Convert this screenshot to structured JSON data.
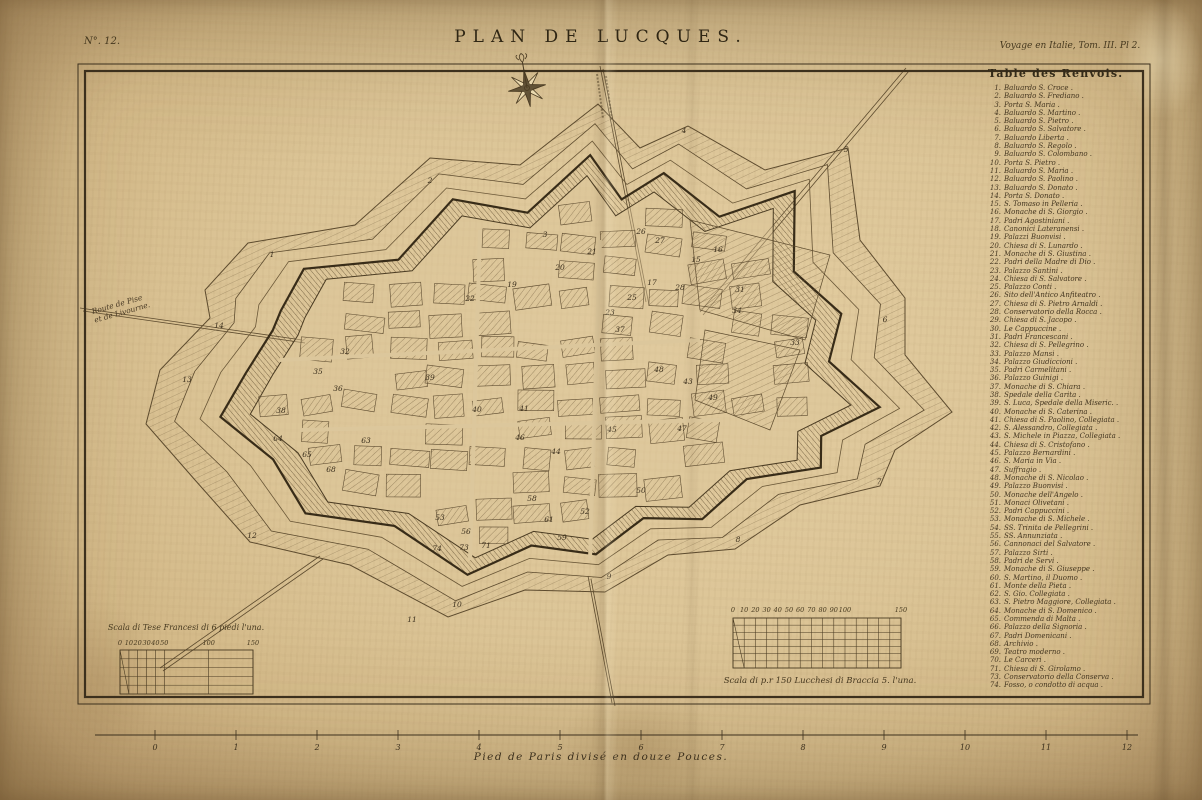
{
  "plate": {
    "number": "N°. 12.",
    "title": "PLAN DE LUCQUES.",
    "edition": "Voyage en Italie, Tom. III. Pl 2.",
    "bottom_caption": "Pied de Paris divisé en douze Pouces."
  },
  "legend": {
    "title": "Table des Renvois.",
    "items": [
      {
        "n": "1",
        "label": "Baluardo S. Croce"
      },
      {
        "n": "2",
        "label": "Baluardo S. Frediano"
      },
      {
        "n": "3",
        "label": "Porta S. Maria"
      },
      {
        "n": "4",
        "label": "Baluardo S. Martino"
      },
      {
        "n": "5",
        "label": "Baluardo S. Pietro"
      },
      {
        "n": "6",
        "label": "Baluardo S. Salvatore"
      },
      {
        "n": "7",
        "label": "Baluardo Liberta"
      },
      {
        "n": "8",
        "label": "Baluardo S. Regolo"
      },
      {
        "n": "9",
        "label": "Baluardo S. Colombano"
      },
      {
        "n": "10",
        "label": "Porta S. Pietro"
      },
      {
        "n": "11",
        "label": "Baluardo S. Maria"
      },
      {
        "n": "12",
        "label": "Baluardo S. Paolino"
      },
      {
        "n": "13",
        "label": "Baluardo S. Donato"
      },
      {
        "n": "14",
        "label": "Porta S. Donato"
      },
      {
        "n": "15",
        "label": "S. Tomaso in Pelleria"
      },
      {
        "n": "16",
        "label": "Monache di S. Giorgio"
      },
      {
        "n": "17",
        "label": "Padri Agostiniani"
      },
      {
        "n": "18",
        "label": "Canonici Lateranensi"
      },
      {
        "n": "19",
        "label": "Palazzi Buonvisi"
      },
      {
        "n": "20",
        "label": "Chiesa di S. Lunardo"
      },
      {
        "n": "21",
        "label": "Monache di S. Giustina"
      },
      {
        "n": "22",
        "label": "Padri della Madre di Dio"
      },
      {
        "n": "23",
        "label": "Palazzo Santini"
      },
      {
        "n": "24",
        "label": "Chiesa di S. Salvatore"
      },
      {
        "n": "25",
        "label": "Palazzo Conti"
      },
      {
        "n": "26",
        "label": "Sito dell'Antico Anfiteatro"
      },
      {
        "n": "27",
        "label": "Chiesa di S. Pietro Arnaldi"
      },
      {
        "n": "28",
        "label": "Conservatorio della Rocca"
      },
      {
        "n": "29",
        "label": "Chiesa di S. Jacopo"
      },
      {
        "n": "30",
        "label": "Le Cappuccine"
      },
      {
        "n": "31",
        "label": "Padri Francescani"
      },
      {
        "n": "32",
        "label": "Chiesa di S. Pellegrino"
      },
      {
        "n": "33",
        "label": "Palazzo Mansi"
      },
      {
        "n": "34",
        "label": "Palazzo Giudiccioni"
      },
      {
        "n": "35",
        "label": "Padri Carmelitani"
      },
      {
        "n": "36",
        "label": "Palazzo Guinigi"
      },
      {
        "n": "37",
        "label": "Monache di S. Chiara"
      },
      {
        "n": "38",
        "label": "Spedale della Carita"
      },
      {
        "n": "39",
        "label": "S. Luca, Spedale della Miseric."
      },
      {
        "n": "40",
        "label": "Monache di S. Caterina"
      },
      {
        "n": "41",
        "label": "Chiesa di S. Paolino, Collegiata"
      },
      {
        "n": "42",
        "label": "S. Alessandro, Collegiata"
      },
      {
        "n": "43",
        "label": "S. Michele in Piazza, Collegiata"
      },
      {
        "n": "44",
        "label": "Chiesa di S. Cristofano"
      },
      {
        "n": "45",
        "label": "Palazzo Bernardini"
      },
      {
        "n": "46",
        "label": "S. Maria in Via"
      },
      {
        "n": "47",
        "label": "Suffragio"
      },
      {
        "n": "48",
        "label": "Monache di S. Nicolao"
      },
      {
        "n": "49",
        "label": "Palazzo Buonvisi"
      },
      {
        "n": "50",
        "label": "Monache dell'Angelo"
      },
      {
        "n": "51",
        "label": "Monaci Olivetani"
      },
      {
        "n": "52",
        "label": "Padri Cappuccini"
      },
      {
        "n": "53",
        "label": "Monache di S. Michele"
      },
      {
        "n": "54",
        "label": "SS. Trinita de Pellegrini"
      },
      {
        "n": "55",
        "label": "SS. Annunziata"
      },
      {
        "n": "56",
        "label": "Cannonaci del Salvatore"
      },
      {
        "n": "57",
        "label": "Palazzo Sirti"
      },
      {
        "n": "58",
        "label": "Padri de Servi"
      },
      {
        "n": "59",
        "label": "Monache di S. Giuseppe"
      },
      {
        "n": "60",
        "label": "S. Martino, il Duomo"
      },
      {
        "n": "61",
        "label": "Monte della Pieta"
      },
      {
        "n": "62",
        "label": "S. Gio. Collegiata"
      },
      {
        "n": "63",
        "label": "S. Pietro Maggiore, Collegiata"
      },
      {
        "n": "64",
        "label": "Monache di S. Domenico"
      },
      {
        "n": "65",
        "label": "Commenda di Malta"
      },
      {
        "n": "66",
        "label": "Palazzo della Signoria"
      },
      {
        "n": "67",
        "label": "Padri Domenicani"
      },
      {
        "n": "68",
        "label": "Archivio"
      },
      {
        "n": "69",
        "label": "Teatro moderno"
      },
      {
        "n": "70",
        "label": "Le Carceri"
      },
      {
        "n": "71",
        "label": "Chiesa di S. Girolamo"
      },
      {
        "n": "73",
        "label": "Conservatorio della Conserva"
      },
      {
        "n": "74",
        "label": "Fosso, o condotto di acqua"
      }
    ]
  },
  "road_label": {
    "line1": "Route de Pise",
    "line2": "et de Livourne."
  },
  "scales": {
    "french": {
      "caption": "Scala di Tese Francesi di 6 piedi l'una.",
      "ticks": [
        "0",
        "10",
        "20",
        "30",
        "40",
        "50",
        "100",
        "150"
      ]
    },
    "lucchese": {
      "caption": "Scala di p.r 150 Lucchesi di Braccia 5. l'una.",
      "ticks": [
        "0",
        "10",
        "20",
        "30",
        "40",
        "50",
        "60",
        "70",
        "80",
        "90",
        "100",
        "150"
      ]
    }
  },
  "ruler": {
    "ticks": [
      "0",
      "1",
      "2",
      "3",
      "4",
      "5",
      "6",
      "7",
      "8",
      "9",
      "10",
      "11",
      "12"
    ]
  },
  "map_markers": [
    {
      "n": "1",
      "x": 272,
      "y": 257
    },
    {
      "n": "2",
      "x": 430,
      "y": 183
    },
    {
      "n": "3",
      "x": 545,
      "y": 237
    },
    {
      "n": "4",
      "x": 684,
      "y": 133
    },
    {
      "n": "5",
      "x": 846,
      "y": 152
    },
    {
      "n": "6",
      "x": 885,
      "y": 322
    },
    {
      "n": "7",
      "x": 879,
      "y": 484
    },
    {
      "n": "8",
      "x": 738,
      "y": 542
    },
    {
      "n": "9",
      "x": 609,
      "y": 579
    },
    {
      "n": "10",
      "x": 457,
      "y": 607
    },
    {
      "n": "11",
      "x": 412,
      "y": 622
    },
    {
      "n": "12",
      "x": 252,
      "y": 538
    },
    {
      "n": "13",
      "x": 187,
      "y": 382
    },
    {
      "n": "14",
      "x": 219,
      "y": 328
    },
    {
      "n": "15",
      "x": 696,
      "y": 262
    },
    {
      "n": "16",
      "x": 718,
      "y": 252
    },
    {
      "n": "17",
      "x": 652,
      "y": 285
    },
    {
      "n": "19",
      "x": 512,
      "y": 287
    },
    {
      "n": "20",
      "x": 560,
      "y": 270
    },
    {
      "n": "21",
      "x": 592,
      "y": 254
    },
    {
      "n": "22",
      "x": 470,
      "y": 301
    },
    {
      "n": "23",
      "x": 610,
      "y": 315
    },
    {
      "n": "25",
      "x": 632,
      "y": 300
    },
    {
      "n": "26",
      "x": 641,
      "y": 234
    },
    {
      "n": "27",
      "x": 660,
      "y": 243
    },
    {
      "n": "28",
      "x": 680,
      "y": 290
    },
    {
      "n": "31",
      "x": 740,
      "y": 292
    },
    {
      "n": "32",
      "x": 345,
      "y": 354
    },
    {
      "n": "33",
      "x": 795,
      "y": 345
    },
    {
      "n": "34",
      "x": 737,
      "y": 313
    },
    {
      "n": "35",
      "x": 318,
      "y": 374
    },
    {
      "n": "36",
      "x": 338,
      "y": 391
    },
    {
      "n": "37",
      "x": 620,
      "y": 332
    },
    {
      "n": "38",
      "x": 281,
      "y": 413
    },
    {
      "n": "39",
      "x": 430,
      "y": 380
    },
    {
      "n": "40",
      "x": 477,
      "y": 412
    },
    {
      "n": "41",
      "x": 524,
      "y": 411
    },
    {
      "n": "43",
      "x": 688,
      "y": 384
    },
    {
      "n": "44",
      "x": 556,
      "y": 454
    },
    {
      "n": "45",
      "x": 612,
      "y": 432
    },
    {
      "n": "46",
      "x": 520,
      "y": 440
    },
    {
      "n": "47",
      "x": 682,
      "y": 431
    },
    {
      "n": "48",
      "x": 659,
      "y": 372
    },
    {
      "n": "49",
      "x": 713,
      "y": 400
    },
    {
      "n": "50",
      "x": 641,
      "y": 493
    },
    {
      "n": "52",
      "x": 585,
      "y": 514
    },
    {
      "n": "53",
      "x": 440,
      "y": 520
    },
    {
      "n": "56",
      "x": 466,
      "y": 534
    },
    {
      "n": "58",
      "x": 532,
      "y": 501
    },
    {
      "n": "59",
      "x": 562,
      "y": 540
    },
    {
      "n": "61",
      "x": 549,
      "y": 522
    },
    {
      "n": "63",
      "x": 366,
      "y": 443
    },
    {
      "n": "64",
      "x": 278,
      "y": 441
    },
    {
      "n": "65",
      "x": 307,
      "y": 457
    },
    {
      "n": "68",
      "x": 331,
      "y": 472
    },
    {
      "n": "71",
      "x": 486,
      "y": 548
    },
    {
      "n": "73",
      "x": 464,
      "y": 550
    },
    {
      "n": "74",
      "x": 437,
      "y": 551
    }
  ],
  "colors": {
    "paper": "#d9c193",
    "ink": "#3e3322",
    "hatch": "#6a5636",
    "frame": "#3c301d"
  }
}
